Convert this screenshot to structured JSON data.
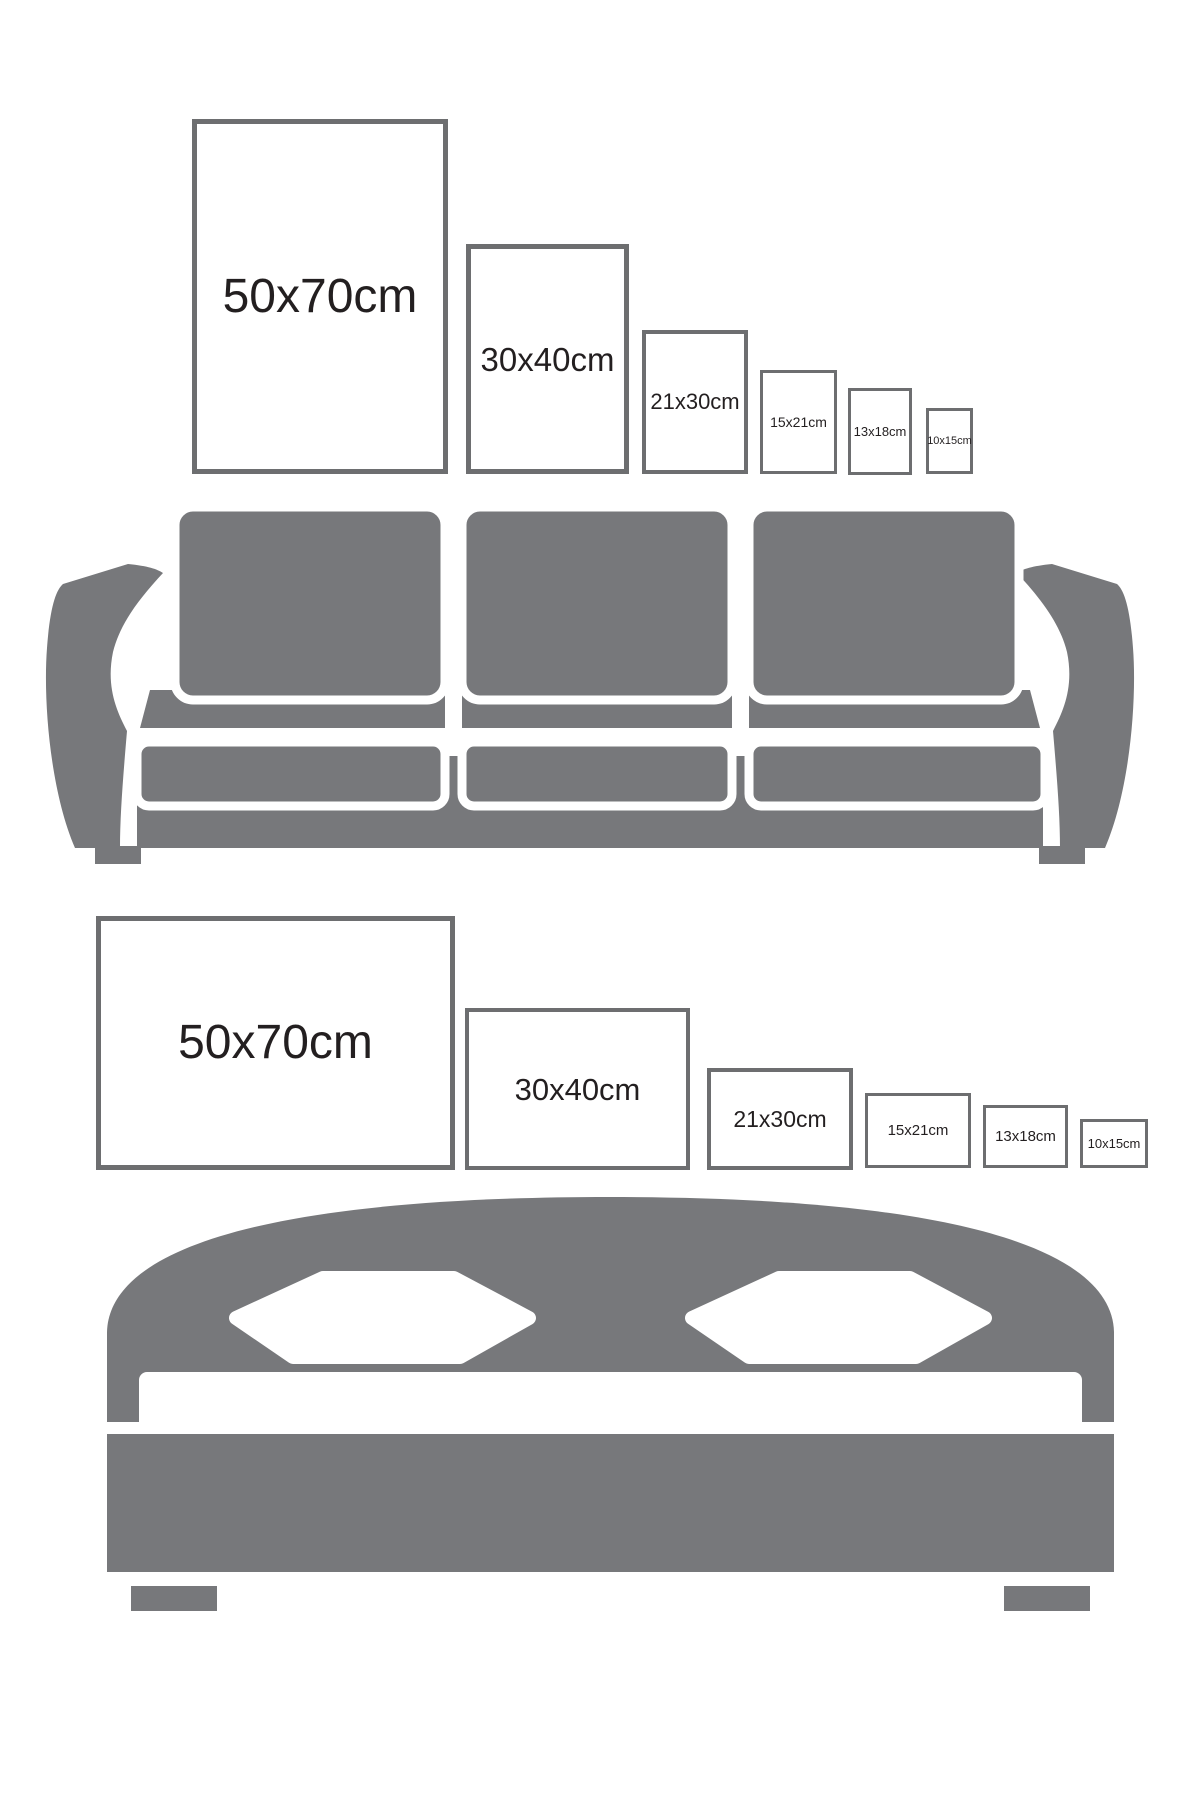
{
  "page": {
    "background": "#ffffff",
    "description_note": ""
  },
  "colors": {
    "furniture_gray": "#77787b",
    "frame_border": "#6d6e70",
    "label_text": "#231f20",
    "cutout_white": "#ffffff"
  },
  "sofa_section": {
    "furniture": "sofa",
    "orientation": "portrait",
    "frames": [
      {
        "label": "50x70cm"
      },
      {
        "label": "30x40cm"
      },
      {
        "label": "21x30cm"
      },
      {
        "label": "15x21cm"
      },
      {
        "label": "13x18cm"
      },
      {
        "label": "10x15cm"
      }
    ]
  },
  "bed_section": {
    "furniture": "bed",
    "orientation": "landscape",
    "frames": [
      {
        "label": "50x70cm"
      },
      {
        "label": "30x40cm"
      },
      {
        "label": "21x30cm"
      },
      {
        "label": "15x21cm"
      },
      {
        "label": "13x18cm"
      },
      {
        "label": "10x15cm"
      }
    ]
  }
}
